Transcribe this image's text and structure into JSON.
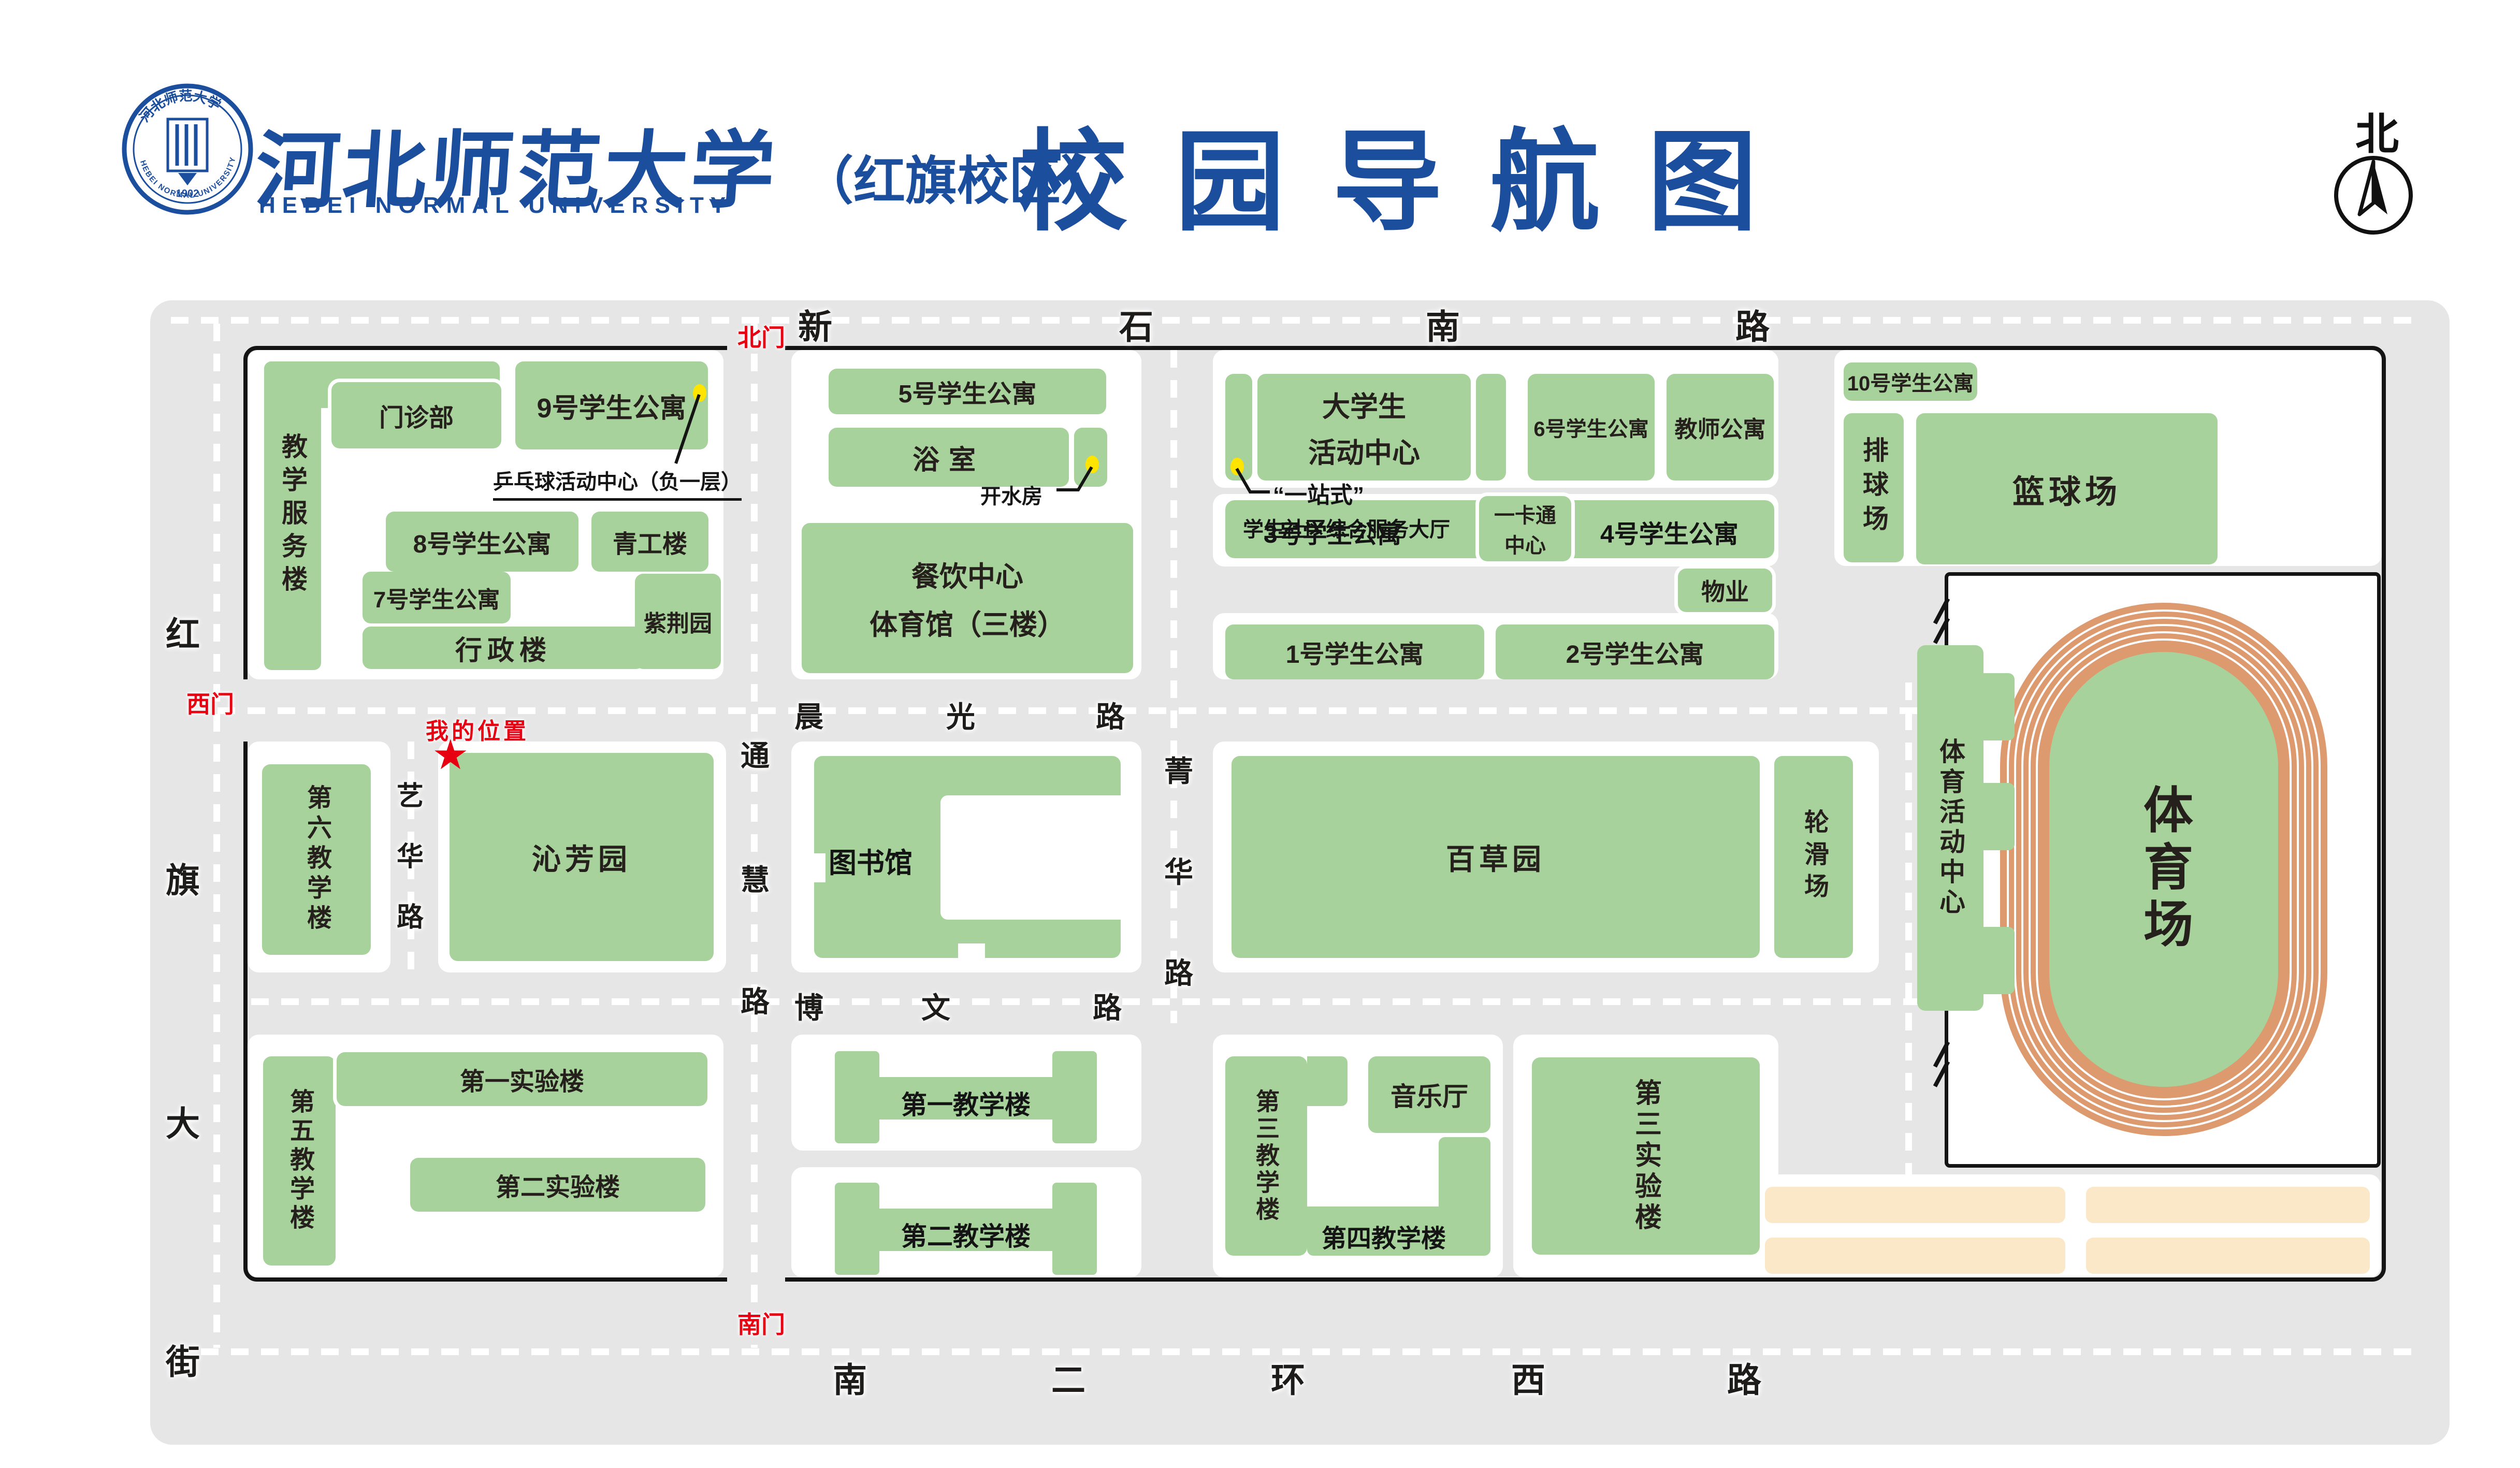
{
  "header": {
    "university_cn": "河北师范大学",
    "campus": "（红旗校区）",
    "university_en": "HEBEI NORMAL UNIVERSITY",
    "title": "校园导航图",
    "north_label": "北",
    "seal_year": "1902"
  },
  "roads": {
    "north": "新石南路",
    "west": "红旗大街",
    "south": "南二环西路",
    "chenguang": "晨光路",
    "bowen": "博文路",
    "tonghui": "通慧路",
    "jinghua": "菁华路",
    "yihua": "艺华路"
  },
  "gates": {
    "north": "北门",
    "west": "西门",
    "south": "南门"
  },
  "marker": {
    "label": "我的位置",
    "star": "★"
  },
  "callouts": {
    "pingpong": "乒乓球活动中心（负一层）",
    "boiler": "开水房",
    "one_stop_line1": "“一站式”",
    "one_stop_line2": "学生社区综合服务大厅"
  },
  "buildings": {
    "teaching_service": "教学服务楼",
    "clinic": "门诊部",
    "dorm9": "9号学生公寓",
    "dorm8": "8号学生公寓",
    "qinggong": "青工楼",
    "dorm7": "7号学生公寓",
    "admin": "行政楼",
    "zijing": "紫荆园",
    "dorm5": "5号学生公寓",
    "bath": "浴室",
    "canteen_line1": "餐饮中心",
    "canteen_line2": "体育馆（三楼）",
    "student_center_line1": "大学生",
    "student_center_line2": "活动中心",
    "dorm6": "6号学生公寓",
    "teacher_apt": "教师公寓",
    "dorm10": "10号学生公寓",
    "volleyball": "排球场",
    "basketball": "篮球场",
    "dorm3": "3号学生公寓",
    "card_line1": "一卡通",
    "card_line2": "中心",
    "dorm4": "4号学生公寓",
    "property": "物业",
    "dorm1": "1号学生公寓",
    "dorm2": "2号学生公寓",
    "library": "图书馆",
    "qinfang": "沁芳园",
    "teach6": "第六教学楼",
    "baicao": "百草园",
    "skating": "轮滑场",
    "sports_center": "体育活动中心",
    "stadium": "体育场",
    "teach5": "第五教学楼",
    "lab1": "第一实验楼",
    "lab2": "第二实验楼",
    "teach1": "第一教学楼",
    "teach2": "第二教学楼",
    "teach3": "第三教学楼",
    "music_hall": "音乐厅",
    "teach4": "第四教学楼",
    "lab3": "第三实验楼"
  },
  "colors": {
    "brand_blue": "#1C4E9E",
    "gate_red": "#E60012",
    "building_green": "#A7D29C",
    "road_gray": "#E6E6E7",
    "track_orange": "#DD9A6E",
    "court_tan": "#FBE8C9",
    "marker_yellow": "#FFE400"
  }
}
